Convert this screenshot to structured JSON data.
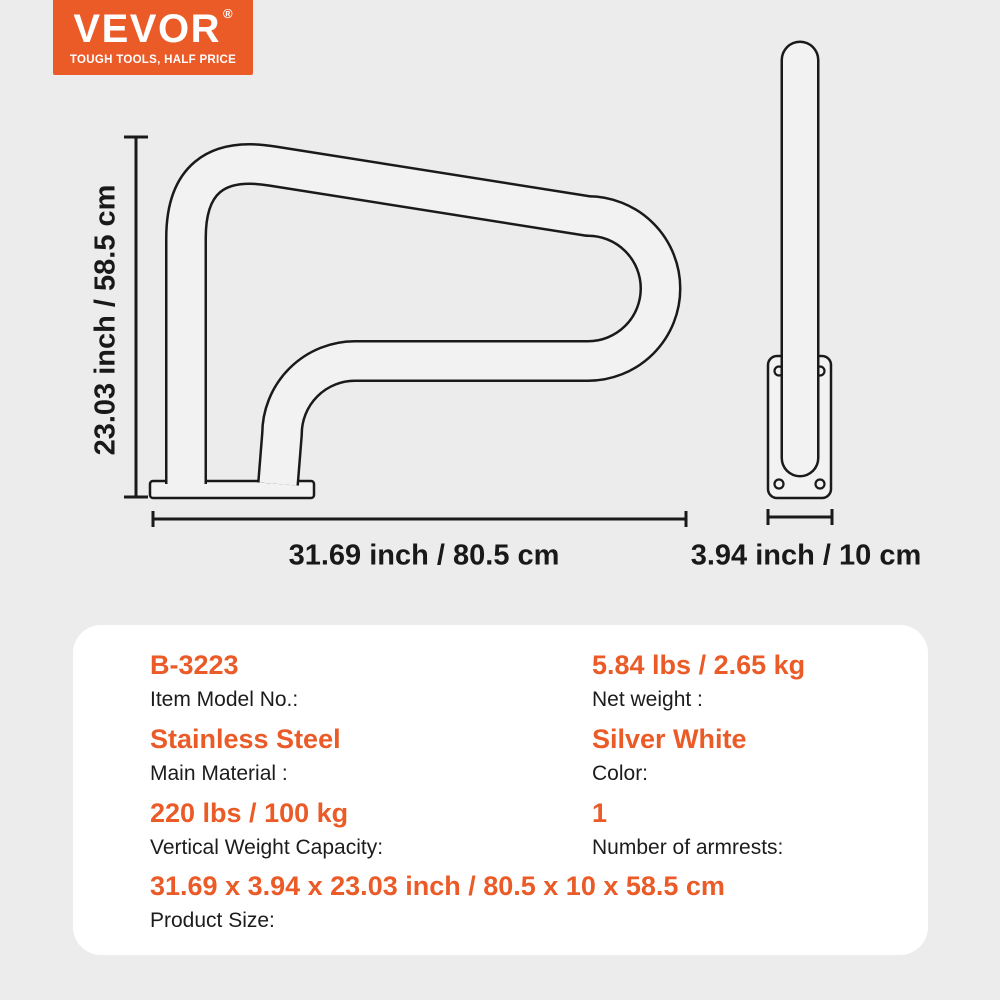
{
  "brand": {
    "name": "VEVOR",
    "registered": "®",
    "tagline": "TOUGH TOOLS, HALF PRICE"
  },
  "diagram": {
    "front_height_label": "23.03 inch / 58.5 cm",
    "front_width_label": "31.69 inch / 80.5 cm",
    "side_width_label": "3.94 inch / 10 cm"
  },
  "specs": [
    {
      "value": "B-3223",
      "label": "Item Model No.:"
    },
    {
      "value": "5.84 lbs / 2.65 kg",
      "label": "Net weight :"
    },
    {
      "value": "Stainless Steel",
      "label": "Main Material :"
    },
    {
      "value": "Silver White",
      "label": "Color:"
    },
    {
      "value": "220 lbs / 100 kg",
      "label": "Vertical Weight Capacity:"
    },
    {
      "value": "1",
      "label": "Number of armrests:"
    },
    {
      "value": "31.69 x 3.94 x 23.03 inch / 80.5 x 10 x 58.5 cm",
      "label": "Product Size:"
    }
  ],
  "colors": {
    "accent": "#EA5B28",
    "background": "#ECECEC",
    "card": "#FFFFFF",
    "line": "#1A1A1A",
    "tube_fill": "#F2F2F2"
  }
}
